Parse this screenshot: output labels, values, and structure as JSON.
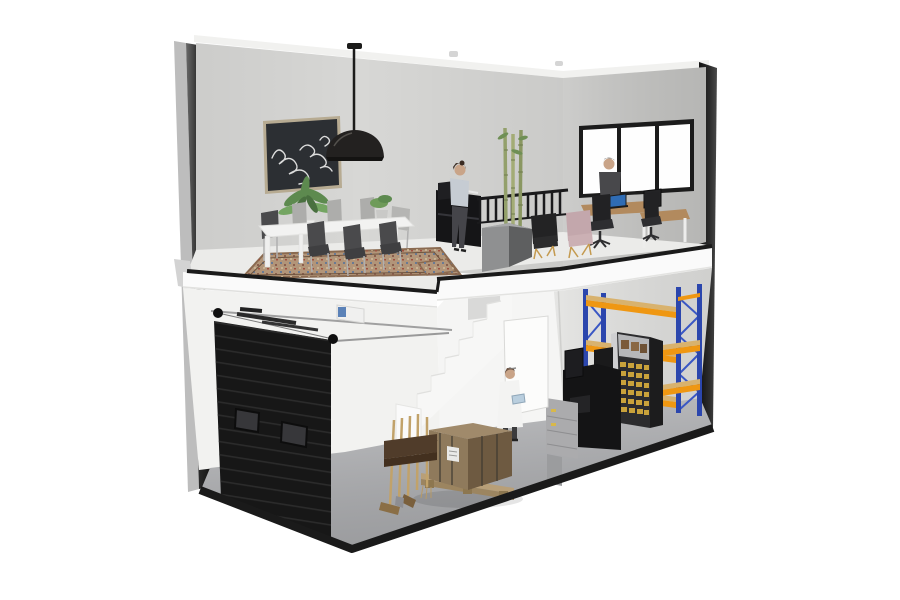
{
  "scene": {
    "description": "3D cutaway rendering of a two-story commercial unit; upstairs open-plan office with dining area, downstairs warehouse with roller door, staircase, crate and pallet racking",
    "upper_floor_objects": [
      "wall-art",
      "pendant-lamp",
      "potted-plant",
      "dining-table",
      "dining-chairs",
      "area-rug",
      "office-printer",
      "standing-woman",
      "stair-railing",
      "bamboo-plant",
      "plinth-cabinet",
      "lounge-chair-black",
      "lounge-chair-pink",
      "office-window",
      "businessman",
      "desks",
      "laptop",
      "monitor",
      "office-chairs"
    ],
    "lower_floor_objects": [
      "roller-door",
      "door-mechanism",
      "garage-opener",
      "staircase",
      "interior-door",
      "warehouse-worker",
      "shipping-crate",
      "pallet",
      "broom-rack",
      "pallet-racking",
      "bin-shelving",
      "workshop-machine",
      "drawer-cabinet"
    ]
  },
  "colors": {
    "wall_back": "#d7d7d5",
    "wall_right": "#c6c6c4",
    "floor_office": "#ebebe9",
    "slab": "#fafafa",
    "trim": "#1a1a1a",
    "strip_light": "#bdbdbd",
    "strip_dark": "#2f2f2f",
    "column": "#1f1f1f",
    "roof_edge": "#f1f1ef",
    "roller_door": "#171717",
    "door_window": "#37373a",
    "concrete": "#b5b6b9",
    "wall_lower": "#f2f2f0",
    "wall_warehouse": "#e2e2e0",
    "stair_white": "#f7f7f6",
    "interior_door": "#fcfcfb",
    "lab_coat": "#f3f3f2",
    "crate_top": "#a08a6b",
    "crate_left": "#8f7a5c",
    "crate_right": "#6e5a41",
    "pallet_wood": "#b89f78",
    "rack_blue": "#2b46ad",
    "rack_orange": "#ef9712",
    "shelf_wood": "#d8b26e",
    "bins_yellow": "#c9a23b",
    "machine_black": "#141415",
    "cabinet_gray": "#ababad",
    "rug_base": "#b29579",
    "rug_border": "#8a6a50",
    "table_white": "#f2f2f1",
    "chair_dark": "#4a4a4c",
    "chair_light": "#adadab",
    "plant_green": "#5d8a4f",
    "art_canvas": "#2c2f33",
    "art_frame": "#b7ab92",
    "lamp_black": "#232120",
    "window_frame": "#1c1c1c",
    "window_glass": "#fefefe",
    "desk_wood": "#b28a5e",
    "office_chair": "#222224",
    "laptop_screen": "#2f6cb4",
    "armchair_black": "#232324",
    "armchair_pink": "#c3a7ac",
    "gold_leg": "#c49a4f",
    "bamboo": "#93a06b",
    "cube_left": "#8f9091",
    "cube_right": "#5e5f60",
    "suit": "#48484b",
    "shirt_blue": "#c6ccd3",
    "skin": "#c9a488",
    "hair_dark": "#3a2b22",
    "printer_black": "#151517",
    "opener_blue": "#5b82b8",
    "rail_metal": "#a0a0a0"
  }
}
